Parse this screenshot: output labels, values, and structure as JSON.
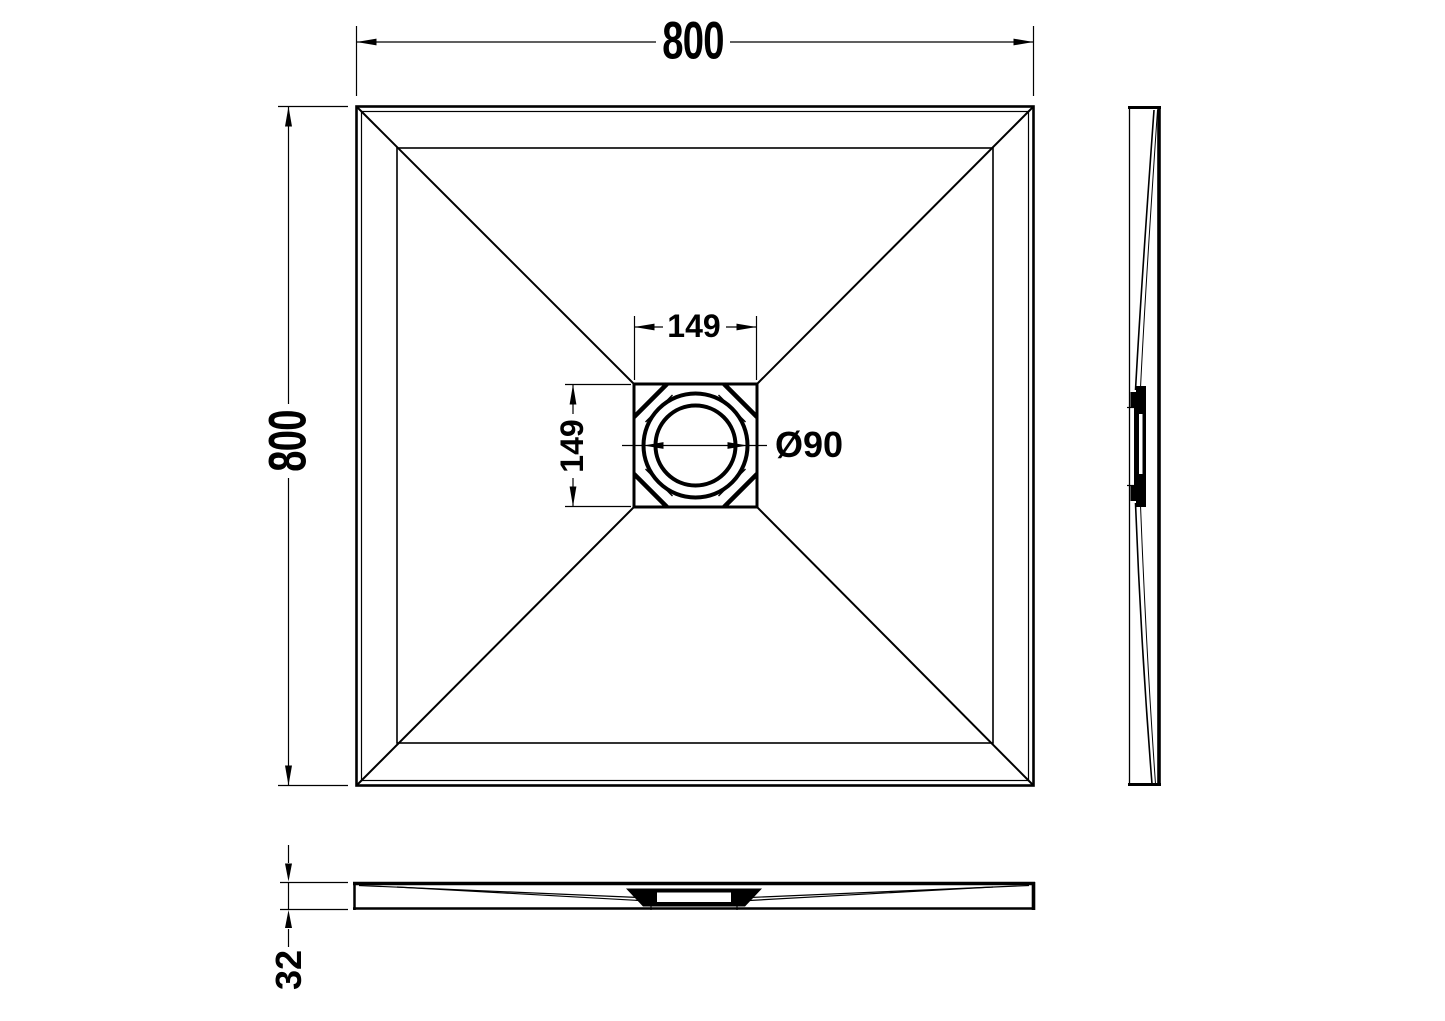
{
  "drawing": {
    "type": "shower-tray-technical-drawing",
    "colors": {
      "line": "#000000",
      "background": "#ffffff"
    },
    "dimensions": {
      "overall_width": "800",
      "overall_depth": "800",
      "drain_cutout_width": "149",
      "drain_cutout_depth": "149",
      "drain_diameter": "Ø90",
      "tray_thickness": "32"
    }
  }
}
